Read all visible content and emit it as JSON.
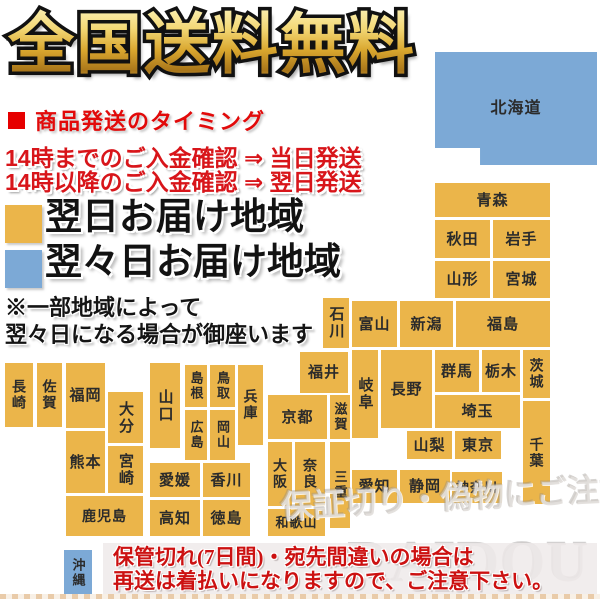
{
  "title": "全国送料無料",
  "shipping": {
    "heading": "商品発送のタイミング",
    "line1": "14時までのご入金確認 ⇒ 当日発送",
    "line2": "14時以降のご入金確認 ⇒ 翌日発送"
  },
  "legend": {
    "next_day": {
      "label": "翌日お届け地域",
      "color": "#EBB54A"
    },
    "two_days": {
      "label": "翌々日お届け地域",
      "color": "#7CA9D6"
    }
  },
  "note": {
    "line1": "※一部地域によって",
    "line2": "翌々日になる場合が御座います"
  },
  "map": {
    "colors": {
      "next_day": "#EBB54A",
      "two_days": "#7CA9D6"
    },
    "prefectures": [
      {
        "id": "hokkaido",
        "label": "北海道",
        "delivery": "two_days",
        "x": 435,
        "y": 52,
        "w": 162,
        "h": 113,
        "vertical": false,
        "fs": 16,
        "notch": true
      },
      {
        "id": "aomori",
        "label": "青森",
        "delivery": "next_day",
        "x": 435,
        "y": 183,
        "w": 115,
        "h": 34,
        "vertical": false
      },
      {
        "id": "akita",
        "label": "秋田",
        "delivery": "next_day",
        "x": 435,
        "y": 220,
        "w": 55,
        "h": 38,
        "vertical": false
      },
      {
        "id": "iwate",
        "label": "岩手",
        "delivery": "next_day",
        "x": 493,
        "y": 220,
        "w": 57,
        "h": 38,
        "vertical": false
      },
      {
        "id": "yamagata",
        "label": "山形",
        "delivery": "next_day",
        "x": 435,
        "y": 261,
        "w": 55,
        "h": 37,
        "vertical": false
      },
      {
        "id": "miyagi",
        "label": "宮城",
        "delivery": "next_day",
        "x": 493,
        "y": 261,
        "w": 57,
        "h": 37,
        "vertical": false
      },
      {
        "id": "ishikawa",
        "label": "石川",
        "delivery": "next_day",
        "x": 323,
        "y": 298,
        "w": 26,
        "h": 50,
        "vertical": true
      },
      {
        "id": "toyama",
        "label": "富山",
        "delivery": "next_day",
        "x": 352,
        "y": 301,
        "w": 45,
        "h": 46,
        "vertical": false
      },
      {
        "id": "niigata",
        "label": "新潟",
        "delivery": "next_day",
        "x": 400,
        "y": 301,
        "w": 53,
        "h": 46,
        "vertical": false
      },
      {
        "id": "fukushima",
        "label": "福島",
        "delivery": "next_day",
        "x": 456,
        "y": 301,
        "w": 94,
        "h": 46,
        "vertical": false
      },
      {
        "id": "gunma",
        "label": "群馬",
        "delivery": "next_day",
        "x": 435,
        "y": 350,
        "w": 44,
        "h": 42,
        "vertical": false
      },
      {
        "id": "tochigi",
        "label": "栃木",
        "delivery": "next_day",
        "x": 482,
        "y": 350,
        "w": 38,
        "h": 42,
        "vertical": false
      },
      {
        "id": "ibaraki",
        "label": "茨城",
        "delivery": "next_day",
        "x": 523,
        "y": 350,
        "w": 27,
        "h": 48,
        "vertical": true,
        "fs": 14
      },
      {
        "id": "saitama",
        "label": "埼玉",
        "delivery": "next_day",
        "x": 435,
        "y": 395,
        "w": 85,
        "h": 33,
        "vertical": false
      },
      {
        "id": "chiba",
        "label": "千葉",
        "delivery": "next_day",
        "x": 523,
        "y": 401,
        "w": 27,
        "h": 103,
        "vertical": true,
        "fs": 14
      },
      {
        "id": "yamanashi",
        "label": "山梨",
        "delivery": "next_day",
        "x": 407,
        "y": 431,
        "w": 45,
        "h": 28,
        "vertical": false
      },
      {
        "id": "tokyo",
        "label": "東京",
        "delivery": "next_day",
        "x": 455,
        "y": 431,
        "w": 46,
        "h": 28,
        "vertical": false
      },
      {
        "id": "kanagawa",
        "label": "神奈川",
        "delivery": "next_day",
        "x": 452,
        "y": 472,
        "w": 50,
        "h": 31,
        "vertical": false,
        "fs": 13
      },
      {
        "id": "nagano",
        "label": "長野",
        "delivery": "next_day",
        "x": 381,
        "y": 350,
        "w": 51,
        "h": 78,
        "vertical": false
      },
      {
        "id": "gifu",
        "label": "岐阜",
        "delivery": "next_day",
        "x": 352,
        "y": 350,
        "w": 26,
        "h": 88,
        "vertical": true
      },
      {
        "id": "fukui",
        "label": "福井",
        "delivery": "next_day",
        "x": 300,
        "y": 352,
        "w": 48,
        "h": 41,
        "vertical": false
      },
      {
        "id": "shizuoka",
        "label": "静岡",
        "delivery": "next_day",
        "x": 400,
        "y": 470,
        "w": 50,
        "h": 33,
        "vertical": false
      },
      {
        "id": "aichi",
        "label": "愛知",
        "delivery": "next_day",
        "x": 352,
        "y": 470,
        "w": 45,
        "h": 33,
        "vertical": false
      },
      {
        "id": "shiga",
        "label": "滋賀",
        "delivery": "next_day",
        "x": 330,
        "y": 395,
        "w": 20,
        "h": 44,
        "vertical": true,
        "fs": 13
      },
      {
        "id": "kyoto",
        "label": "京都",
        "delivery": "next_day",
        "x": 268,
        "y": 395,
        "w": 59,
        "h": 44,
        "vertical": false
      },
      {
        "id": "mie",
        "label": "三重",
        "delivery": "next_day",
        "x": 330,
        "y": 442,
        "w": 20,
        "h": 86,
        "vertical": true,
        "fs": 13
      },
      {
        "id": "osaka",
        "label": "大阪",
        "delivery": "next_day",
        "x": 268,
        "y": 442,
        "w": 24,
        "h": 64,
        "vertical": true,
        "fs": 14
      },
      {
        "id": "nara",
        "label": "奈良",
        "delivery": "next_day",
        "x": 295,
        "y": 442,
        "w": 30,
        "h": 64,
        "vertical": true,
        "fs": 14
      },
      {
        "id": "wakayama",
        "label": "和歌山",
        "delivery": "next_day",
        "x": 268,
        "y": 509,
        "w": 57,
        "h": 27,
        "vertical": false,
        "fs": 13
      },
      {
        "id": "hyogo",
        "label": "兵庫",
        "delivery": "next_day",
        "x": 238,
        "y": 365,
        "w": 25,
        "h": 80,
        "vertical": true,
        "fs": 14
      },
      {
        "id": "tottori",
        "label": "鳥取",
        "delivery": "next_day",
        "x": 210,
        "y": 365,
        "w": 25,
        "h": 42,
        "vertical": true,
        "fs": 13
      },
      {
        "id": "shimane",
        "label": "島根",
        "delivery": "next_day",
        "x": 185,
        "y": 365,
        "w": 22,
        "h": 42,
        "vertical": true,
        "fs": 13
      },
      {
        "id": "okayama",
        "label": "岡山",
        "delivery": "next_day",
        "x": 210,
        "y": 410,
        "w": 25,
        "h": 50,
        "vertical": true,
        "fs": 13
      },
      {
        "id": "hiroshima",
        "label": "広島",
        "delivery": "next_day",
        "x": 185,
        "y": 410,
        "w": 22,
        "h": 50,
        "vertical": true,
        "fs": 13
      },
      {
        "id": "yamaguchi",
        "label": "山口",
        "delivery": "next_day",
        "x": 150,
        "y": 363,
        "w": 30,
        "h": 85,
        "vertical": true
      },
      {
        "id": "ehime",
        "label": "愛媛",
        "delivery": "next_day",
        "x": 150,
        "y": 463,
        "w": 50,
        "h": 34,
        "vertical": false
      },
      {
        "id": "kagawa",
        "label": "香川",
        "delivery": "next_day",
        "x": 203,
        "y": 463,
        "w": 47,
        "h": 34,
        "vertical": false
      },
      {
        "id": "kochi",
        "label": "高知",
        "delivery": "next_day",
        "x": 150,
        "y": 500,
        "w": 50,
        "h": 36,
        "vertical": false
      },
      {
        "id": "tokushima",
        "label": "徳島",
        "delivery": "next_day",
        "x": 203,
        "y": 500,
        "w": 47,
        "h": 36,
        "vertical": false
      },
      {
        "id": "nagasaki",
        "label": "長崎",
        "delivery": "next_day",
        "x": 5,
        "y": 363,
        "w": 28,
        "h": 64,
        "vertical": true,
        "fs": 14
      },
      {
        "id": "saga",
        "label": "佐賀",
        "delivery": "next_day",
        "x": 37,
        "y": 363,
        "w": 25,
        "h": 64,
        "vertical": true,
        "fs": 14
      },
      {
        "id": "fukuoka",
        "label": "福岡",
        "delivery": "next_day",
        "x": 66,
        "y": 363,
        "w": 39,
        "h": 65,
        "vertical": false
      },
      {
        "id": "oita",
        "label": "大分",
        "delivery": "next_day",
        "x": 108,
        "y": 392,
        "w": 35,
        "h": 51,
        "vertical": true
      },
      {
        "id": "kumamoto",
        "label": "熊本",
        "delivery": "next_day",
        "x": 66,
        "y": 431,
        "w": 39,
        "h": 62,
        "vertical": false
      },
      {
        "id": "miyazaki",
        "label": "宮崎",
        "delivery": "next_day",
        "x": 108,
        "y": 446,
        "w": 35,
        "h": 47,
        "vertical": true
      },
      {
        "id": "kagoshima",
        "label": "鹿児島",
        "delivery": "next_day",
        "x": 66,
        "y": 496,
        "w": 77,
        "h": 40,
        "vertical": false,
        "fs": 14
      },
      {
        "id": "okinawa",
        "label": "沖縄",
        "delivery": "two_days",
        "x": 64,
        "y": 550,
        "w": 28,
        "h": 45,
        "vertical": true,
        "fs": 13
      }
    ]
  },
  "notice": {
    "line1": "保管切れ(7日間)・宛先間違いの場合は",
    "line2": "再送は着払いになりますので、ご注意下さい。"
  },
  "watermarks": {
    "brand": "RAIDOU",
    "caution": "保証切り・偽物にご注意下さい"
  }
}
